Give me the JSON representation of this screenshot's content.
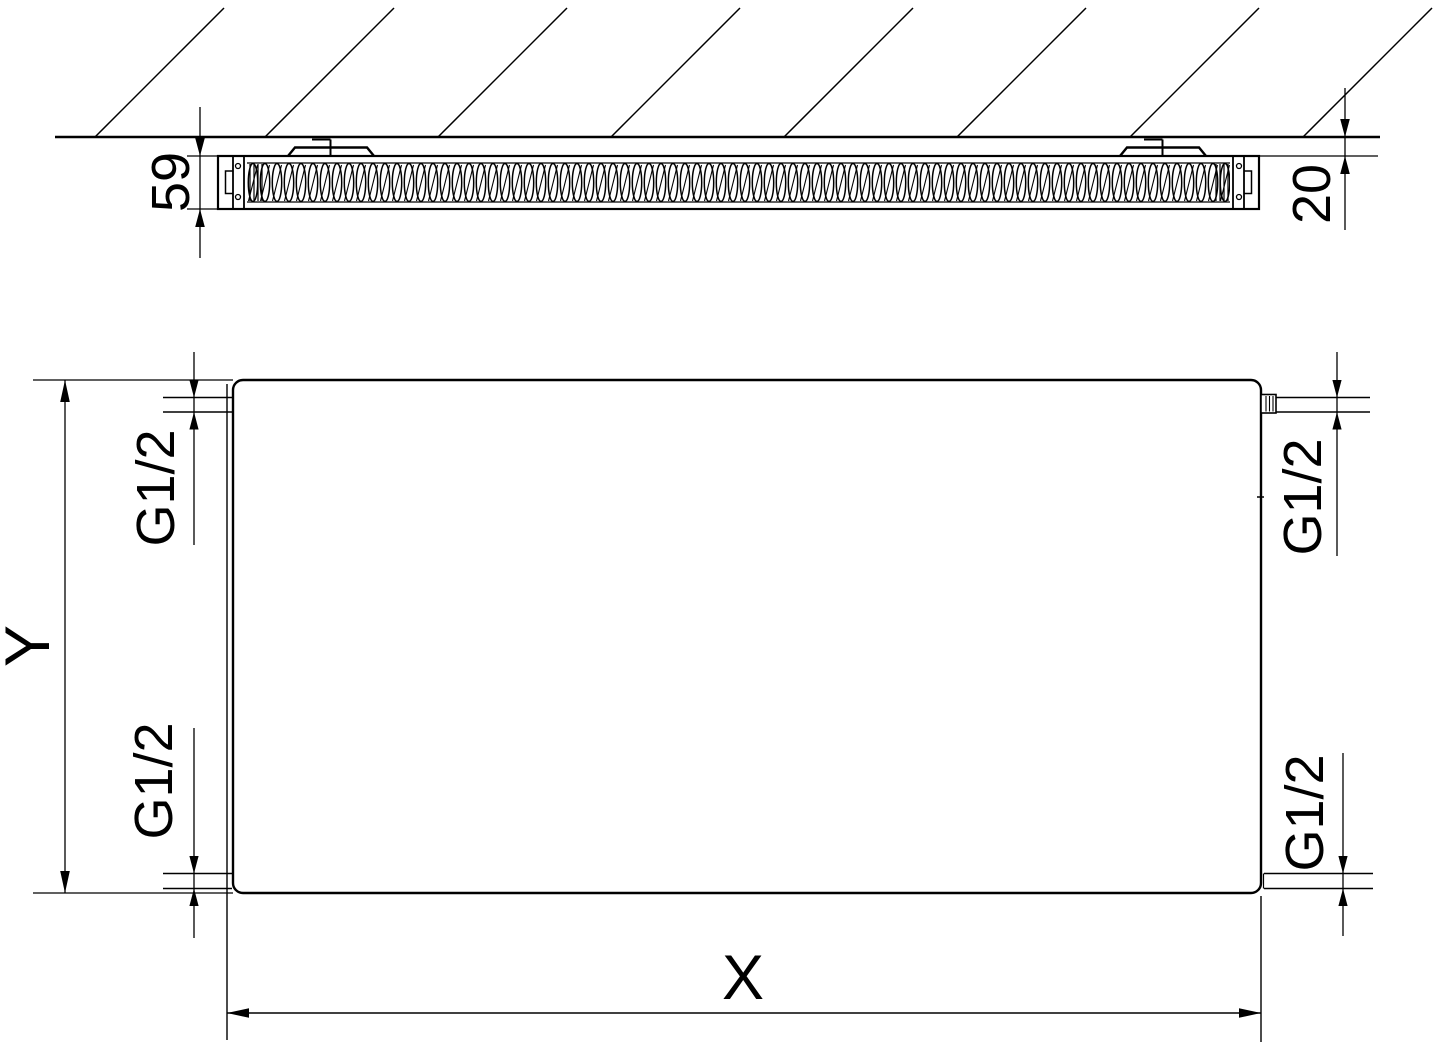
{
  "drawing": {
    "section_view": {
      "depth_label": "59",
      "wall_clearance_label": "20"
    },
    "front_view": {
      "width_label": "X",
      "height_label": "Y",
      "connection_top_left": "G1/2",
      "connection_top_right": "G1/2",
      "connection_bottom_left": "G1/2",
      "connection_bottom_right": "G1/2"
    },
    "colors": {
      "line": "#000000",
      "background": "#ffffff"
    }
  }
}
